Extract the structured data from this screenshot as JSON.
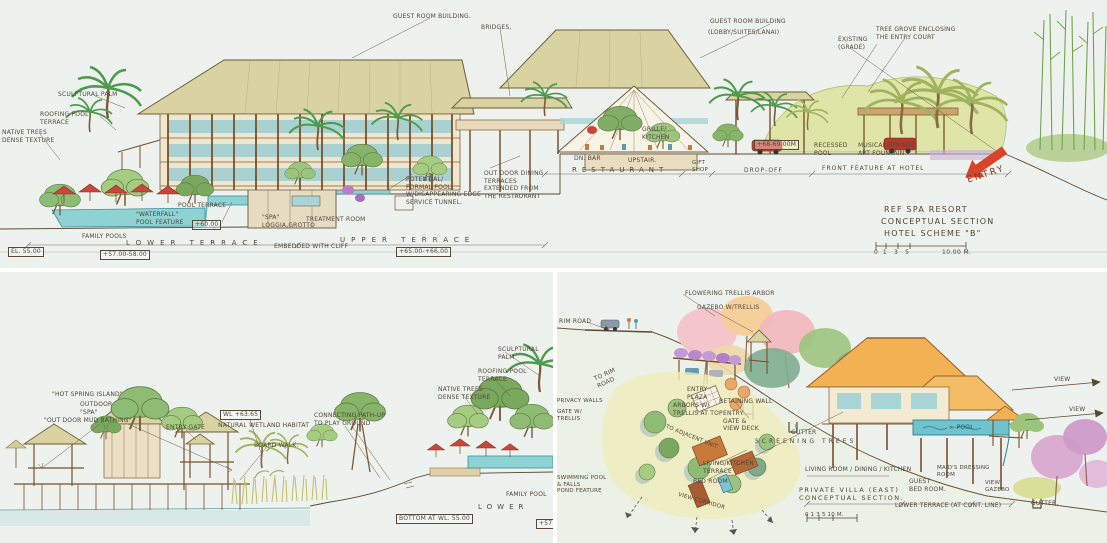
{
  "drawing": {
    "title_block": {
      "line1": "REF SPA RESORT",
      "line2": "CONCEPTUAL SECTION",
      "line3": "HOTEL SCHEME \"B\"",
      "scale_ticks": "0  1   3   5",
      "scale_label": "10.00 M."
    },
    "palette": {
      "paper": "#eef2ee",
      "ink": "#5b4a33",
      "roof_khaki": "#d8d3a0",
      "roof_orange": "#f2b254",
      "water": "#8ed2d4",
      "umbrella_red": "#c8463a",
      "entry_arrow_red": "#d8442a",
      "foliage_light": "#cede9b",
      "foliage_mid": "#9cc47c",
      "foliage_dark": "#74a861",
      "flower_pink": "#f3c3c9",
      "flower_purple": "#c39bd4"
    }
  },
  "panels": {
    "top": {
      "name": "hotel-conceptual-section",
      "annotations": [
        {
          "t": "GUEST ROOM BUILDING.",
          "x": 393,
          "y": 13
        },
        {
          "t": "BRIDGES,",
          "x": 481,
          "y": 24
        },
        {
          "t": "GUEST ROOM BUILDING",
          "x": 710,
          "y": 18
        },
        {
          "t": "(LOBBY/SUITES/LANAI)",
          "x": 708,
          "y": 29
        },
        {
          "t": "EXISTING\n(GRADE)",
          "x": 838,
          "y": 36
        },
        {
          "t": "TREE GROVE ENCLOSING\nTHE ENTRY COURT",
          "x": 876,
          "y": 26
        },
        {
          "t": "SCULPTURAL PALM",
          "x": 58,
          "y": 91
        },
        {
          "t": "ROOFING POOL\nTERRACE",
          "x": 40,
          "y": 111
        },
        {
          "t": "NATIVE TREES\nDENSE TEXTURE",
          "x": 2,
          "y": 129
        },
        {
          "t": "POOL TERRACE",
          "x": 178,
          "y": 202
        },
        {
          "t": "\"WATERFALL\"\nPOOL FEATURE",
          "x": 136,
          "y": 211
        },
        {
          "t": "+60.00",
          "x": 192,
          "y": 220,
          "box": true
        },
        {
          "t": "FAMILY POOLS",
          "x": 82,
          "y": 233
        },
        {
          "t": "LOWER TERRACE",
          "x": 126,
          "y": 239,
          "s": 7,
          "ls": 6
        },
        {
          "t": "EL. 55.00",
          "x": 8,
          "y": 247,
          "box": true
        },
        {
          "t": "+57.00-58.00",
          "x": 100,
          "y": 250,
          "box": true
        },
        {
          "t": "\"SPA\"\nLOGGIA,GROTTO",
          "x": 262,
          "y": 214
        },
        {
          "t": "TREATMENT ROOM",
          "x": 306,
          "y": 216
        },
        {
          "t": "EMBEDDED WITH CLIFF",
          "x": 274,
          "y": 243
        },
        {
          "t": "UPPER TERRACE",
          "x": 340,
          "y": 236,
          "s": 7,
          "ls": 6
        },
        {
          "t": "+65.00-+66.00",
          "x": 396,
          "y": 247,
          "box": true
        },
        {
          "t": "POTENTIAL/\nFORMAL POOL\nW/DISAPPEARING EDGE\nSERVICE TUNNEL.",
          "x": 406,
          "y": 176
        },
        {
          "t": "OUT DOOR DINING\nTERRACES\nEXTENDED FROM\nTHE RESTAURANT",
          "x": 484,
          "y": 170
        },
        {
          "t": "DN. BAR",
          "x": 574,
          "y": 155
        },
        {
          "t": "UPSTAIR.",
          "x": 628,
          "y": 157
        },
        {
          "t": "GRILLE/\nKITCHEN",
          "x": 642,
          "y": 126
        },
        {
          "t": "RESTAURANT",
          "x": 572,
          "y": 166,
          "s": 7,
          "ls": 5
        },
        {
          "t": "GIFT\nSHOP",
          "x": 692,
          "y": 160,
          "s": 5.5
        },
        {
          "t": "DROP-OFF",
          "x": 744,
          "y": 167,
          "ls": 1
        },
        {
          "t": "FRONT FEATURE AT HOTEL",
          "x": 822,
          "y": 165,
          "ls": 1
        },
        {
          "t": "+68-69.00M",
          "x": 754,
          "y": 140,
          "box": true
        },
        {
          "t": "RECESSED\nPOOL",
          "x": 814,
          "y": 142
        },
        {
          "t": "MUSICAL SPRING/\nART FOUNTAIN",
          "x": 858,
          "y": 142
        },
        {
          "t": "ENTRY",
          "x": 966,
          "y": 176,
          "s": 9,
          "r": -18,
          "c": "#8a3324",
          "ls": 2
        }
      ]
    },
    "bottom_left": {
      "name": "hot-spring-island-section",
      "annotations": [
        {
          "t": "\"HOT SPRING ISLAND\"",
          "x": 52,
          "y": 119
        },
        {
          "t": "OUTDOOR\n\"SPA\"",
          "x": 80,
          "y": 129
        },
        {
          "t": "\"OUT DOOR MUD BATHING\"",
          "x": 44,
          "y": 145
        },
        {
          "t": "ENTRY GATE",
          "x": 166,
          "y": 152
        },
        {
          "t": "WL +63.65",
          "x": 220,
          "y": 138,
          "box": true
        },
        {
          "t": "NATURAL WETLAND HABITAT",
          "x": 218,
          "y": 150
        },
        {
          "t": "BOARD WALK.",
          "x": 254,
          "y": 170
        },
        {
          "t": "CONNECTING PATH-UP\nTO PLAY GROUND",
          "x": 314,
          "y": 140
        },
        {
          "t": "SCULPTURAL PALM",
          "x": 498,
          "y": 74
        },
        {
          "t": "ROOFING POOL\nTERRACE",
          "x": 478,
          "y": 96
        },
        {
          "t": "NATIVE TREES\nDENSE TEXTURE",
          "x": 438,
          "y": 114
        },
        {
          "t": "FAMILY POOL",
          "x": 506,
          "y": 219
        },
        {
          "t": "LOWER",
          "x": 478,
          "y": 231,
          "s": 7,
          "ls": 5
        },
        {
          "t": "BOTTOM AT WL. 55.00",
          "x": 396,
          "y": 242,
          "box": true
        },
        {
          "t": "+57.0",
          "x": 536,
          "y": 247,
          "box": true
        }
      ]
    },
    "bottom_right": {
      "name": "private-villa-east-section",
      "annotations": [
        {
          "t": "RIM ROAD",
          "x": 2,
          "y": 46
        },
        {
          "t": "FLOWERING TRELLIS ARBOR",
          "x": 128,
          "y": 18
        },
        {
          "t": "GAZEBO W/TRELLIS",
          "x": 140,
          "y": 32
        },
        {
          "t": "TO RIM\nROAD",
          "x": 36,
          "y": 104,
          "r": -24
        },
        {
          "t": "ENTRY\nPLAZA",
          "x": 130,
          "y": 114
        },
        {
          "t": "ARBORS W/\nTRELLIS AT TOP",
          "x": 116,
          "y": 130
        },
        {
          "t": "RETAINING WALL",
          "x": 162,
          "y": 126
        },
        {
          "t": "ENTRY\nGATE &\nVIEW DECK",
          "x": 166,
          "y": 138
        },
        {
          "t": "TO ADJACENT UNIT",
          "x": 110,
          "y": 152,
          "r": 22,
          "s": 5.5
        },
        {
          "t": "GUTTER",
          "x": 234,
          "y": 157
        },
        {
          "t": "SCREENING TREES",
          "x": 198,
          "y": 166,
          "ls": 3
        },
        {
          "t": "PRIVACY WALLS",
          "x": 0,
          "y": 126,
          "s": 5.5
        },
        {
          "t": "GATE W/\nTRELLIS",
          "x": 0,
          "y": 137,
          "s": 5.5
        },
        {
          "t": "SWIMMING POOL\n& FALLS",
          "x": 0,
          "y": 203,
          "s": 5.5
        },
        {
          "t": "POND FEATURE",
          "x": 0,
          "y": 216,
          "s": 5.5
        },
        {
          "t": "LIVING/KITCHEN\nTERRACE",
          "x": 146,
          "y": 188
        },
        {
          "t": "BED ROOM",
          "x": 136,
          "y": 206
        },
        {
          "t": "VIEW CORRIDOR",
          "x": 122,
          "y": 220,
          "r": 16,
          "s": 5.5
        },
        {
          "t": "LIVING ROOM / DINING / KITCHEN",
          "x": 248,
          "y": 194
        },
        {
          "t": "MAID'S DRESSING\nROOM",
          "x": 380,
          "y": 193,
          "s": 5.5
        },
        {
          "t": "GUEST\nBED ROOM.",
          "x": 352,
          "y": 206
        },
        {
          "t": "VIEW\nGAZEBO",
          "x": 428,
          "y": 208,
          "s": 5.5
        },
        {
          "t": "GUTTER.",
          "x": 474,
          "y": 228
        },
        {
          "t": "PRIVATE VILLA (EAST)\nCONCEPTUAL SECTION.",
          "x": 242,
          "y": 214,
          "s": 6.5,
          "ls": 1.5
        },
        {
          "t": "LOWER TERRACE (AT CONT. LINE)",
          "x": 338,
          "y": 230
        },
        {
          "t": "∞-POOL",
          "x": 392,
          "y": 152,
          "c": "#1d4f58"
        },
        {
          "t": "VIEW",
          "x": 497,
          "y": 104
        },
        {
          "t": "VIEW",
          "x": 512,
          "y": 134
        },
        {
          "t": "0 1  3  5   10 M.",
          "x": 248,
          "y": 240,
          "s": 5.5
        }
      ]
    }
  }
}
